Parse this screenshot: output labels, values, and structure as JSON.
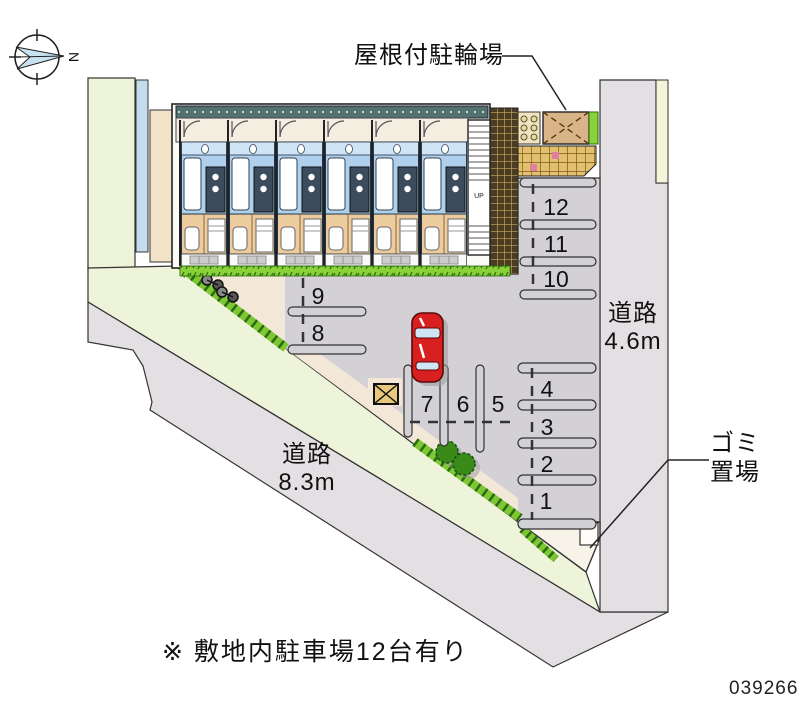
{
  "compass": {
    "north_label": "N"
  },
  "labels": {
    "bicycle_parking": "屋根付駐輪場",
    "road_right_line1": "道路",
    "road_right_line2": "4.6m",
    "road_diag_line1": "道路",
    "road_diag_line2": "8.3m",
    "garbage_line1": "ゴミ",
    "garbage_line2": "置場",
    "note": "※ 敷地内駐車場12台有り",
    "stairs_up": "UP"
  },
  "plan_number": "039266",
  "parking": {
    "spaces": [
      "1",
      "2",
      "3",
      "4",
      "5",
      "6",
      "7",
      "8",
      "9",
      "10",
      "11",
      "12"
    ]
  },
  "colors": {
    "road": "#e3dfe3",
    "sidewalk_green": "#eef4da",
    "sidewalk_cream": "#f6f4d8",
    "asphalt": "#d3d1d5",
    "parcel_green": "#eef4da",
    "parcel_blue": "#c4dcec",
    "parcel_tan": "#f2e2c8",
    "hedge": "#7dc832",
    "hedge_dark": "#2a6a10",
    "bush": "#3a8a1a",
    "walkway": "#f3e7d7",
    "roof": "#53716f",
    "corridor": "#f4eee0",
    "unit_bath": "#aed0ec",
    "unit_room": "#eccb9e",
    "bike_roof": "#d8b488",
    "car_red": "#d92020",
    "bar_fill": "#d2d2d6"
  }
}
